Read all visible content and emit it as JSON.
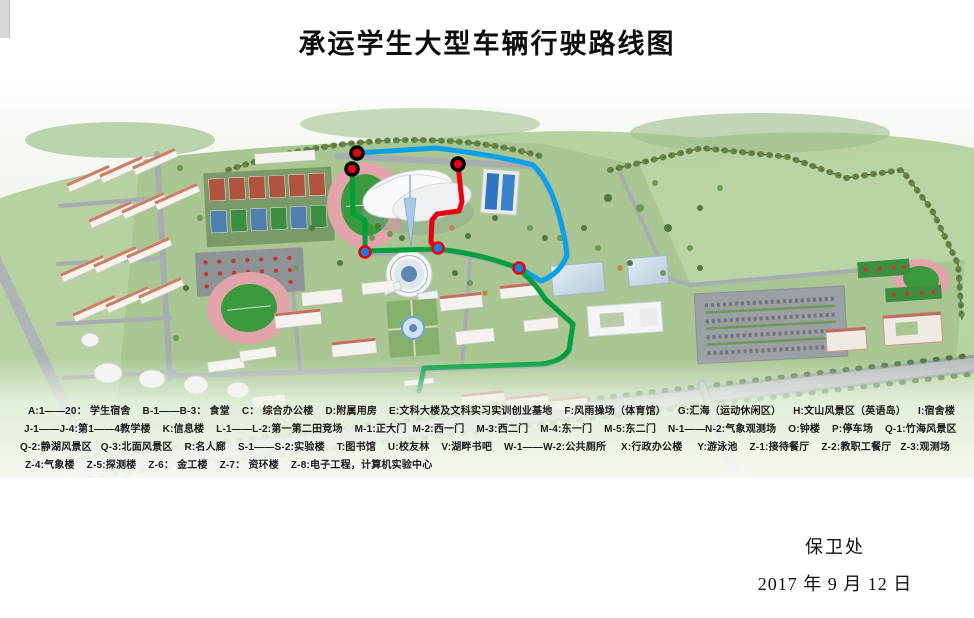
{
  "page": {
    "title": "承运学生大型车辆行驶路线图",
    "footer": {
      "department": "保卫处",
      "date": "2017 年 9 月 12 日"
    }
  },
  "legend": {
    "lines": [
      "A:1——20： 学生宿舍    B-1——B-3： 食堂    C： 综合办公楼    D:附属用房    E:文科大楼及文科实习实训创业基地    F:风雨操场（体育馆）    G:汇海（运动休闲区）    H:文山风景区（英语岛）    I:宿舍楼",
      "J-1——J-4:第1——4教学楼    K:信息楼    L-1——L-2:第一第二田竞场    M-1:正大门  M-2:西一门    M-3:西二门    M-4:东一门    M-5:东二门    N-1——N-2:气象观测场    O:钟楼    P:停车场    Q-1:竹海风景区",
      "Q-2:静湖风景区   Q-3:北面风景区    R:名人廊    S-1——S-2:实验楼    T:图书馆    U:校友林    V:湖畔书吧    W-1——W-2:公共厕所     X:行政办公楼     Y:游泳池    Z-1:接待餐厅    Z-2:教职工餐厅   Z-3:观测场",
      "Z-4:气象楼    Z-5:探测楼    Z-6： 金工楼    Z-7： 资环楼    Z-8:电子工程，计算机实验中心"
    ]
  },
  "map": {
    "routes": {
      "red": {
        "color": "#e60012"
      },
      "green": {
        "color": "#009f3c"
      },
      "blue": {
        "color": "#0aa0e8"
      }
    },
    "markers": {
      "start_fill": "#e60012",
      "start_ring": "#000000",
      "end_fill": "#1d7fd8",
      "end_ring": "#e60012"
    }
  }
}
